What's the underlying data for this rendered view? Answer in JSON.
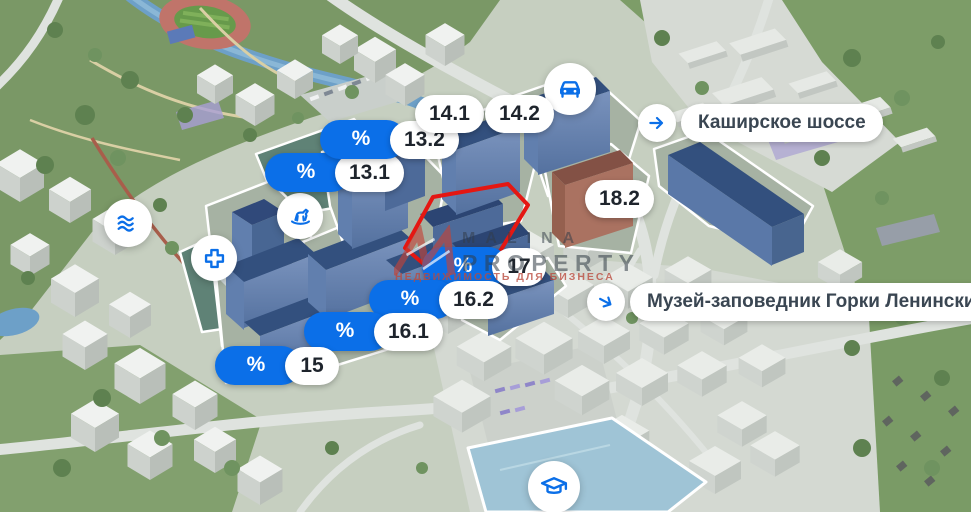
{
  "map": {
    "discount_symbol": "%",
    "buildings": [
      {
        "label": "13.1",
        "discount": true
      },
      {
        "label": "13.2",
        "discount": true
      },
      {
        "label": "14.1",
        "discount": false
      },
      {
        "label": "14.2",
        "discount": false
      },
      {
        "label": "15",
        "discount": true
      },
      {
        "label": "16.1",
        "discount": true
      },
      {
        "label": "16.2",
        "discount": true
      },
      {
        "label": "17",
        "discount": true
      },
      {
        "label": "18.2",
        "discount": false
      }
    ],
    "locations": [
      {
        "label": "Каширское шоссе"
      },
      {
        "label": "Музей-заповедник Горки Ленинские"
      }
    ],
    "amenities": [
      "car",
      "waterfront",
      "clinic",
      "kindergarten",
      "school"
    ],
    "watermark": {
      "line1": "MALINA",
      "line2": "PROPERTY",
      "tagline": "НЕДВИЖИМОСТЬ ДЛЯ БИЗНЕСА"
    },
    "colors": {
      "accent_blue": "#0B6FE8",
      "highlight_red": "#E41712",
      "pill_text": "#1E242C"
    }
  }
}
